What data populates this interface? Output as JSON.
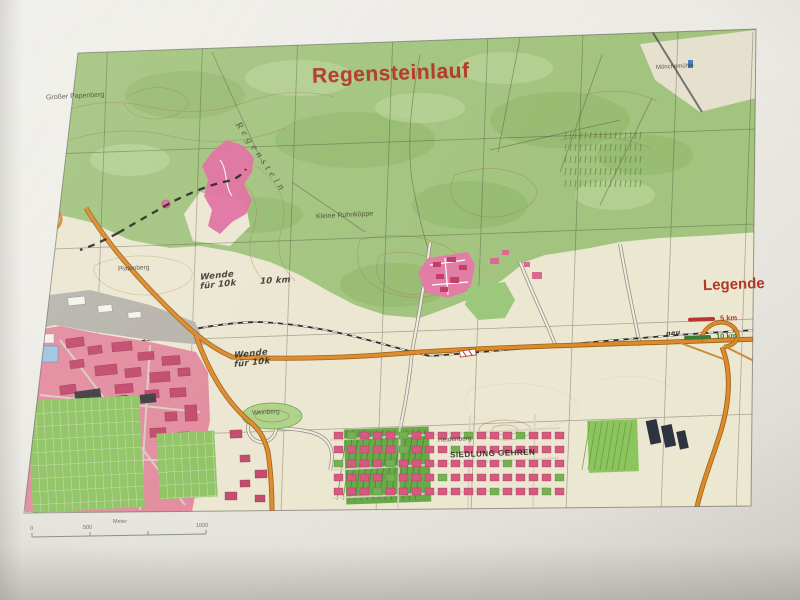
{
  "map": {
    "title": "Regensteinlauf",
    "legend": {
      "title": "Legende",
      "item_5km": "5 km",
      "item_10km": "10 km",
      "note": "neu"
    },
    "places": {
      "grosser_papenberg": "Großer Papenberg",
      "regenstein": "Regenstein",
      "kleine_ruhnkoppe": "Kleine Ruhnköppe",
      "platenberg": "Platenberg",
      "moenchemuehle": "Mönchemühle",
      "siedlung_gehren": "SIEDLUNG GEHREN",
      "heidenberg": "Heidenberg",
      "weinberg": "Weinberg"
    },
    "annotations": {
      "wende1_line1": "Wende",
      "wende1_line2": "für 10k",
      "wende1_right": "10 km",
      "wende2_line1": "Wende",
      "wende2_line2": "für 10k"
    },
    "scalebar": {
      "zero": "0",
      "five_hundred": "500",
      "unit": "Meter",
      "thousand": "1000"
    },
    "colors": {
      "title_red": "#b23824",
      "course_red": "#b5382a",
      "course_green": "#3c7a36",
      "forest_green": "#a3c47f",
      "urban_pink": "#e28b9e",
      "road_orange": "#dd8a2c"
    }
  }
}
